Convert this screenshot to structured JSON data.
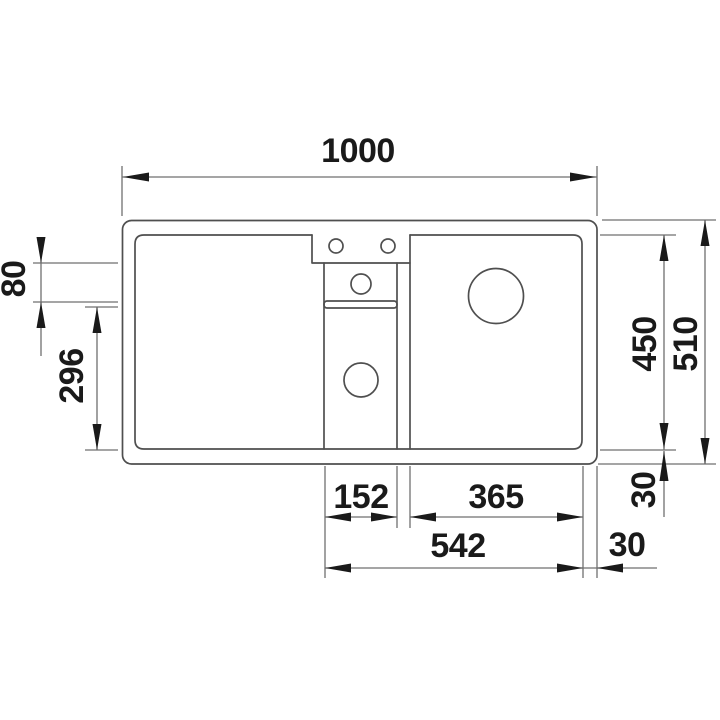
{
  "drawing": {
    "title": "sink-technical-drawing-top-view",
    "units": "mm",
    "geometry_line_color": "#4f4f4f",
    "dimension_line_color": "#6f6f6f",
    "text_color": "#1a1a1a",
    "background_color": "#ffffff",
    "labels": {
      "overall_width": "1000",
      "deck_band_height": "80",
      "half_bowl_length": "296",
      "inner_depth": "450",
      "overall_depth": "510",
      "rim_depth_bottom": "30",
      "half_bowl_width": "152",
      "main_bowl_width": "365",
      "bowls_overall_width": "542",
      "rim_width_right": "30"
    }
  }
}
